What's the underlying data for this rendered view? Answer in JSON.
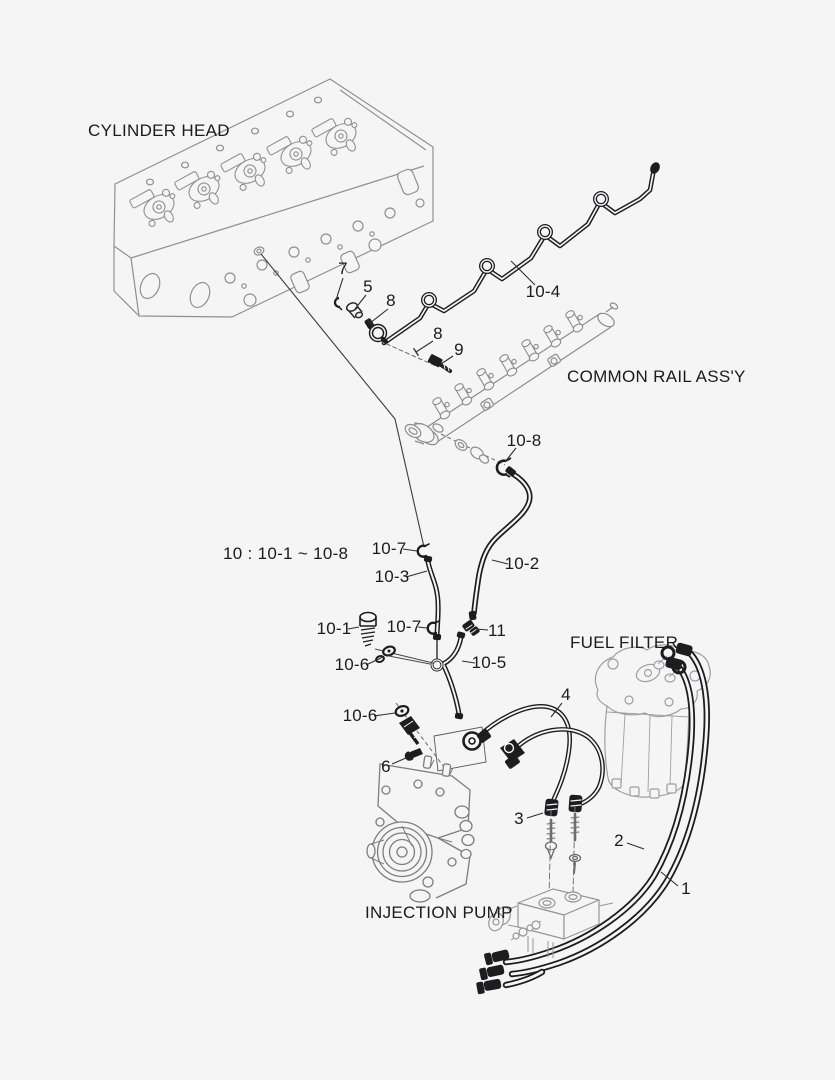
{
  "diagram": {
    "kind": "exploded-parts-diagram",
    "subject": "engine fuel piping"
  },
  "theme": {
    "background": "#f5f5f6",
    "ink": "#1b1b1d",
    "part_line": "#1d1d1f",
    "context_line_head": "#909090",
    "context_line_rail": "#8c8c8c",
    "context_line_filter": "#9aa0a2",
    "context_line_pump": "#7d7d7d",
    "context_line_manifold": "#969696",
    "leader_line": "#2e2e2e"
  },
  "labels": {
    "cylinder_head": "CYLINDER HEAD",
    "common_rail": "COMMON RAIL ASS'Y",
    "fuel_filter": "FUEL FILTER",
    "injection_pump": "INJECTION PUMP",
    "group_note": "10 : 10-1 ~ 10-8"
  },
  "callouts": [
    {
      "text": "7",
      "x": 343,
      "y": 269,
      "leader": [
        [
          343,
          278
        ],
        [
          336,
          300
        ]
      ]
    },
    {
      "text": "5",
      "x": 368,
      "y": 287,
      "leader": [
        [
          366,
          295
        ],
        [
          355,
          309
        ]
      ]
    },
    {
      "text": "8",
      "x": 391,
      "y": 301,
      "leader": [
        [
          388,
          309
        ],
        [
          370,
          323
        ]
      ],
      "tick": true
    },
    {
      "text": "8",
      "x": 438,
      "y": 334,
      "leader": [
        [
          433,
          341
        ],
        [
          416,
          352
        ]
      ],
      "tick": true
    },
    {
      "text": "9",
      "x": 459,
      "y": 350,
      "leader": [
        [
          453,
          356
        ],
        [
          441,
          364
        ]
      ]
    },
    {
      "text": "10-4",
      "x": 543,
      "y": 292,
      "leader": [
        [
          535,
          285
        ],
        [
          511,
          261
        ]
      ]
    },
    {
      "text": "10-8",
      "x": 524,
      "y": 441,
      "leader": [
        [
          516,
          448
        ],
        [
          505,
          462
        ]
      ]
    },
    {
      "text": "10-7",
      "x": 389,
      "y": 549,
      "leader": [
        [
          403,
          549
        ],
        [
          417,
          551
        ]
      ]
    },
    {
      "text": "10-3",
      "x": 392,
      "y": 577,
      "leader": [
        [
          406,
          577
        ],
        [
          427,
          571
        ]
      ]
    },
    {
      "text": "10-2",
      "x": 522,
      "y": 564,
      "leader": [
        [
          508,
          564
        ],
        [
          492,
          560
        ]
      ]
    },
    {
      "text": "10-1",
      "x": 334,
      "y": 629,
      "leader": [
        [
          348,
          629
        ],
        [
          359,
          627
        ]
      ]
    },
    {
      "text": "10-7",
      "x": 404,
      "y": 627,
      "leader": [
        [
          418,
          627
        ],
        [
          427,
          628
        ]
      ]
    },
    {
      "text": "11",
      "x": 497,
      "y": 631,
      "leader": [
        [
          488,
          630
        ],
        [
          476,
          629
        ]
      ]
    },
    {
      "text": "10-6",
      "x": 352,
      "y": 665,
      "leader": [
        [
          366,
          665
        ],
        [
          383,
          657
        ]
      ]
    },
    {
      "text": "10-5",
      "x": 489,
      "y": 663,
      "leader": [
        [
          475,
          663
        ],
        [
          462,
          661
        ]
      ]
    },
    {
      "text": "10-6",
      "x": 360,
      "y": 716,
      "leader": [
        [
          374,
          716
        ],
        [
          395,
          713
        ]
      ]
    },
    {
      "text": "6",
      "x": 386,
      "y": 767,
      "leader": [
        [
          392,
          764
        ],
        [
          406,
          758
        ]
      ]
    },
    {
      "text": "4",
      "x": 566,
      "y": 695,
      "leader": [
        [
          562,
          703
        ],
        [
          551,
          717
        ]
      ]
    },
    {
      "text": "3",
      "x": 519,
      "y": 819,
      "leader": [
        [
          527,
          818
        ],
        [
          543,
          813
        ]
      ]
    },
    {
      "text": "2",
      "x": 619,
      "y": 841,
      "leader": [
        [
          627,
          843
        ],
        [
          644,
          849
        ]
      ]
    },
    {
      "text": "1",
      "x": 686,
      "y": 889,
      "leader": [
        [
          678,
          886
        ],
        [
          661,
          872
        ]
      ]
    }
  ]
}
